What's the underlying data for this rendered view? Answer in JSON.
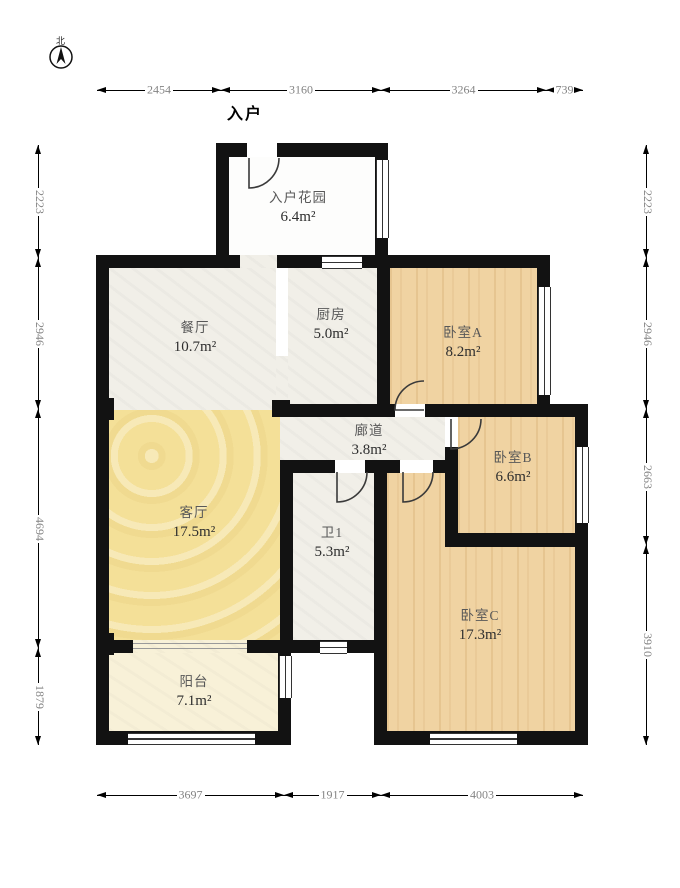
{
  "compass": {
    "label": "北"
  },
  "entry_label": "入户",
  "rooms": [
    {
      "id": "garden",
      "name": "入户花园",
      "area": "6.4m²"
    },
    {
      "id": "dining",
      "name": "餐厅",
      "area": "10.7m²"
    },
    {
      "id": "kitchen",
      "name": "厨房",
      "area": "5.0m²"
    },
    {
      "id": "bedroomA",
      "name": "卧室A",
      "area": "8.2m²"
    },
    {
      "id": "corridor",
      "name": "廊道",
      "area": "3.8m²"
    },
    {
      "id": "bedroomB",
      "name": "卧室B",
      "area": "6.6m²"
    },
    {
      "id": "living",
      "name": "客厅",
      "area": "17.5m²"
    },
    {
      "id": "bath",
      "name": "卫1",
      "area": "5.3m²"
    },
    {
      "id": "bedroomC",
      "name": "卧室C",
      "area": "17.3m²"
    },
    {
      "id": "balcony",
      "name": "阳台",
      "area": "7.1m²"
    }
  ],
  "dimensions": {
    "top": [
      "2454",
      "3160",
      "3264",
      "739"
    ],
    "left": [
      "2223",
      "2946",
      "4694",
      "1879"
    ],
    "right": [
      "2223",
      "2946",
      "2663",
      "3910"
    ],
    "bottom": [
      "3697",
      "1917",
      "4003"
    ]
  },
  "colors": {
    "wall": "#121212",
    "wood_floor": "#f0d3a2",
    "living_floor": "#f4e098",
    "balcony_floor": "#f8f1d8",
    "tile_floor": "#f1efe8",
    "dimension_text": "#838383"
  }
}
